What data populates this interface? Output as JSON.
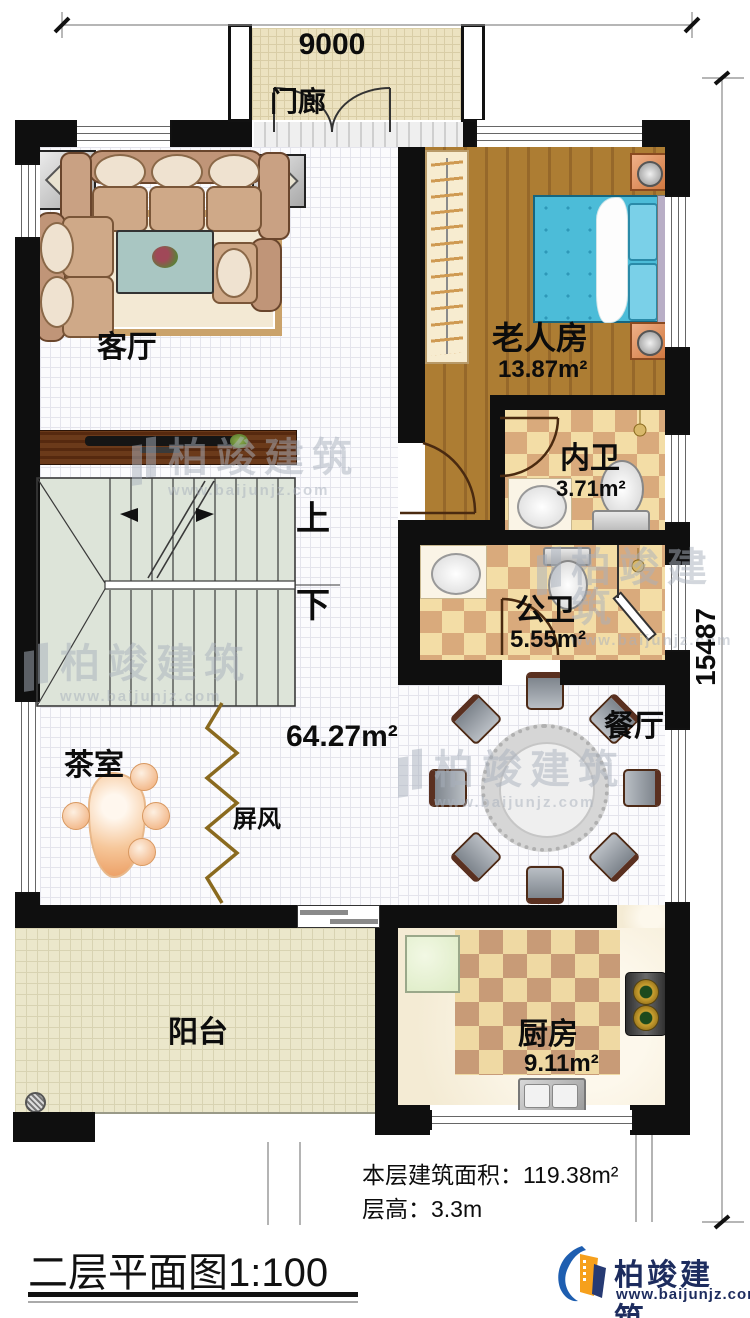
{
  "dimensions": {
    "top_width": "9000",
    "right_height": "15487"
  },
  "rooms": {
    "porch": {
      "name": "门廊"
    },
    "living": {
      "name": "客厅"
    },
    "elder": {
      "name": "老人房",
      "area": "13.87m²"
    },
    "inner_bath": {
      "name": "内卫",
      "area": "3.71m²"
    },
    "public_bath": {
      "name": "公卫",
      "area": "5.55m²"
    },
    "hall": {
      "area": "64.27m²"
    },
    "stairs": {
      "up": "上",
      "down": "下"
    },
    "dining": {
      "name": "餐厅"
    },
    "tea": {
      "name": "茶室"
    },
    "screen": {
      "name": "屏风"
    },
    "balcony": {
      "name": "阳台"
    },
    "kitchen": {
      "name": "厨房",
      "area": "9.11m²"
    }
  },
  "footer": {
    "floor_area": "本层建筑面积：119.38m²",
    "floor_height": "层高：3.3m",
    "plan_title": "二层平面图",
    "plan_scale": "1:100"
  },
  "brand": {
    "name": "柏竣建筑",
    "url": "www.baijunjz.com"
  },
  "watermark": {
    "name": "柏竣建筑",
    "url": "www.baijunjz.com"
  }
}
